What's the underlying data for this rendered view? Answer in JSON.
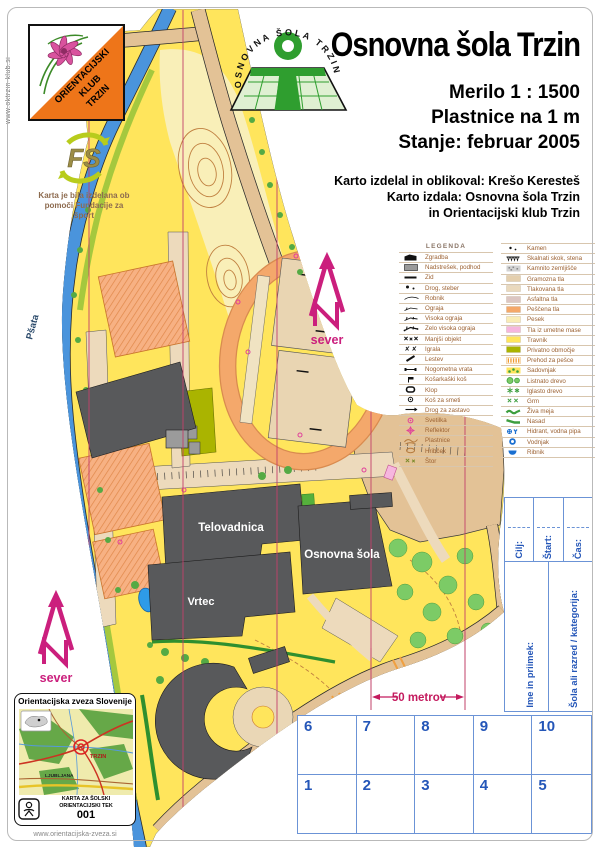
{
  "header": {
    "title": "Osnovna šola Trzin",
    "scale_line": "Merilo 1 : 1500",
    "contour_line": "Plastnice na 1 m",
    "status_line": "Stanje: februar 2005",
    "credits": [
      "Karto izdelal in oblikoval: Krešo Keresteš",
      "Karto izdala: Osnovna šola Trzin",
      "in Orientacijski klub Trzin"
    ],
    "club_logo_lines": [
      "ORIENTACIJSKI",
      "KLUB",
      "TRZIN"
    ],
    "club_website": "www.oktrzin-klub.si",
    "school_logo_text": "OSNOVNA ŠOLA TRZIN"
  },
  "sponsor": {
    "logo_text": "FS",
    "caption_line1": "Karta je bila izdelana ob",
    "caption_line2": "pomoči Fundacije za šport"
  },
  "legend": {
    "title": "LEGENDA",
    "left": [
      {
        "icon": "building",
        "label": "Zgradba"
      },
      {
        "icon": "canopy",
        "label": "Nadstrešek, podhod"
      },
      {
        "icon": "wall",
        "label": "Zid"
      },
      {
        "icon": "pole",
        "label": "Drog, steber"
      },
      {
        "icon": "curb",
        "label": "Robnik"
      },
      {
        "icon": "fence",
        "label": "Ograja"
      },
      {
        "icon": "fence-high",
        "label": "Visoka ograja"
      },
      {
        "icon": "fence-veryhigh",
        "label": "Zelo visoka ograja"
      },
      {
        "icon": "small-object",
        "label": "Manjši objekt"
      },
      {
        "icon": "playground",
        "label": "Igrala"
      },
      {
        "icon": "ladder",
        "label": "Lestev"
      },
      {
        "icon": "goal",
        "label": "Nogometna vrata"
      },
      {
        "icon": "basket",
        "label": "Košarkaški koš"
      },
      {
        "icon": "bench",
        "label": "Klop"
      },
      {
        "icon": "bin",
        "label": "Koš za smeti"
      },
      {
        "icon": "flagpole",
        "label": "Drog za zastavo"
      },
      {
        "icon": "lamp",
        "label": "Svetilka"
      },
      {
        "icon": "floodlight",
        "label": "Reflektor"
      },
      {
        "icon": "contours",
        "label": "Plastnice"
      },
      {
        "icon": "knoll",
        "label": "Hribček"
      },
      {
        "icon": "stump",
        "label": "Štor"
      }
    ],
    "right": [
      {
        "icon": "stone",
        "label": "Kamen"
      },
      {
        "icon": "rockface",
        "label": "Skalnati skok, stena"
      },
      {
        "icon": "stony",
        "label": "Kamnito zemljišče"
      },
      {
        "icon": "block",
        "color": "#e4cfae",
        "label": "Gramozna tla"
      },
      {
        "icon": "block",
        "color": "#ead9bd",
        "label": "Tlakovana tla"
      },
      {
        "icon": "block",
        "color": "#dcc6c2",
        "label": "Asfaltna tla"
      },
      {
        "icon": "block",
        "color": "#f5a869",
        "label": "Peščena tla"
      },
      {
        "icon": "block",
        "color": "#f9ecb5",
        "label": "Pesek"
      },
      {
        "icon": "block",
        "color": "#f6b6de",
        "label": "Tla iz umetne mase"
      },
      {
        "icon": "block",
        "color": "#ffe55c",
        "label": "Travnik"
      },
      {
        "icon": "block",
        "color": "#aab400",
        "label": "Privatno območje"
      },
      {
        "icon": "crosswalk",
        "label": "Prehod za pešce"
      },
      {
        "icon": "orchard",
        "label": "Sadovnjak"
      },
      {
        "icon": "tree",
        "label": "Listnato drevo"
      },
      {
        "icon": "conifer",
        "label": "Iglasto drevo"
      },
      {
        "icon": "shrub",
        "label": "Grm"
      },
      {
        "icon": "hedge",
        "label": "Živa meja"
      },
      {
        "icon": "nasad",
        "label": "Nasad"
      },
      {
        "icon": "hydrant",
        "label": "Hidrant, vodna pipa"
      },
      {
        "icon": "well",
        "label": "Vodnjak"
      },
      {
        "icon": "pond",
        "label": "Ribnik"
      }
    ]
  },
  "map": {
    "labels": {
      "river": "Pšata",
      "gym": "Telovadnica",
      "school": "Osnovna šola",
      "kindergarten": "Vrtec"
    },
    "north_label": "sever",
    "scale_bar": "50 metrov"
  },
  "issuer_card": {
    "title": "Orientacijska zveza Slovenije",
    "place": "TRZIN",
    "city": "LJUBLJANA",
    "type_line1": "KARTA ZA ŠOLSKI",
    "type_line2": "ORIENTACIJSKI TEK",
    "number": "001",
    "website": "www.orientacijska-zveza.si"
  },
  "control_card": {
    "finish": "Cilj:",
    "start": "Štart:",
    "time": "Čas:",
    "name": "Ime in priimek:",
    "category": "Šola ali razred / kategorija:",
    "cells": [
      "6",
      "7",
      "8",
      "9",
      "10",
      "1",
      "2",
      "3",
      "4",
      "5"
    ]
  },
  "colors": {
    "open_land_yellow": "#ffe55c",
    "rough_open_pale": "#f9efb8",
    "sand_orange": "#f5a869",
    "paved_tan": "#e3c296",
    "building_gray": "#58595b",
    "river_blue": "#4a94dc",
    "magenta_overprint": "#cb1f7d",
    "north_line_red": "#c2406a",
    "card_blue": "#2456b8",
    "legend_text_brown": "#9c6233",
    "club_orange": "#ee7519",
    "school_green": "#2f9e2f"
  }
}
